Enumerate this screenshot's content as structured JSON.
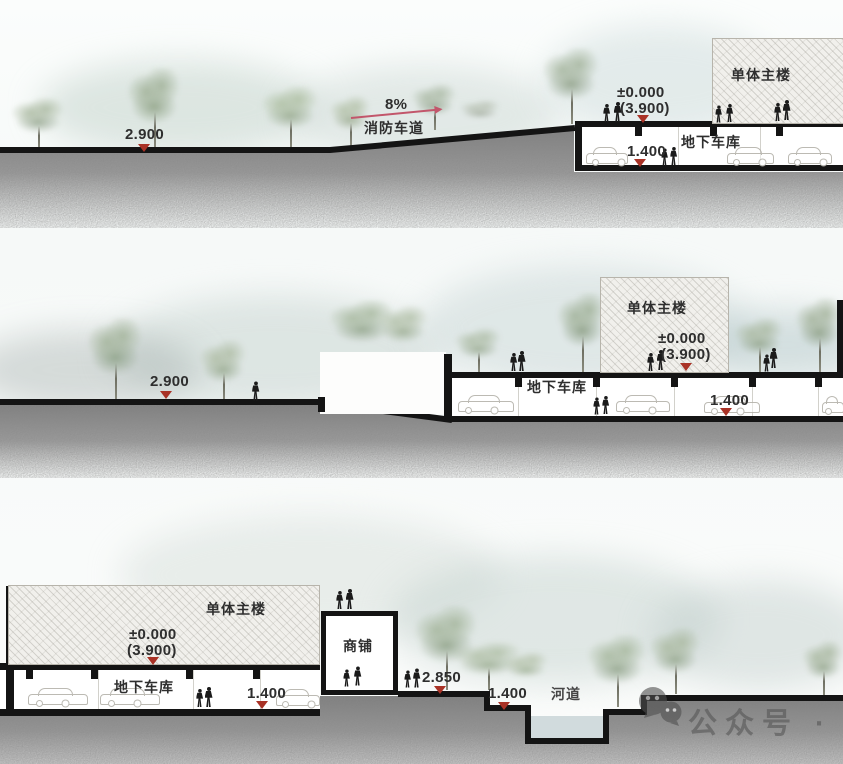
{
  "title": "site-section-diagrams",
  "sections": [
    {
      "name": "section-1",
      "labels": {
        "ground": "2.900",
        "slope": "8%",
        "fire_lane": "消防车道",
        "building": "单体主楼",
        "zero": "±0.000",
        "zero_paren": "(3.900)",
        "garage": "地下车库",
        "garage_level": "1.400"
      }
    },
    {
      "name": "section-2",
      "labels": {
        "ground": "2.900",
        "building": "单体主楼",
        "zero": "±0.000",
        "zero_paren": "(3.900)",
        "garage": "地下车库",
        "garage_level": "1.400"
      }
    },
    {
      "name": "section-3",
      "labels": {
        "building": "单体主楼",
        "zero": "±0.000",
        "zero_paren": "(3.900)",
        "garage": "地下车库",
        "garage_level": "1.400",
        "shop": "商铺",
        "plaza": "2.850",
        "riverside": "1.400",
        "river": "河道"
      }
    }
  ],
  "watermark": {
    "text": "公众号 · 华",
    "icon": "wechat-icon"
  },
  "colors": {
    "line": "#141414",
    "elevation_marker": "#a93226",
    "earth": "#8e8e8e",
    "water": "#ccd7d9",
    "slope_arrow": "#c2566b",
    "hatch_fill": "#f1f0ec",
    "watermark": "#5a5a5a"
  }
}
